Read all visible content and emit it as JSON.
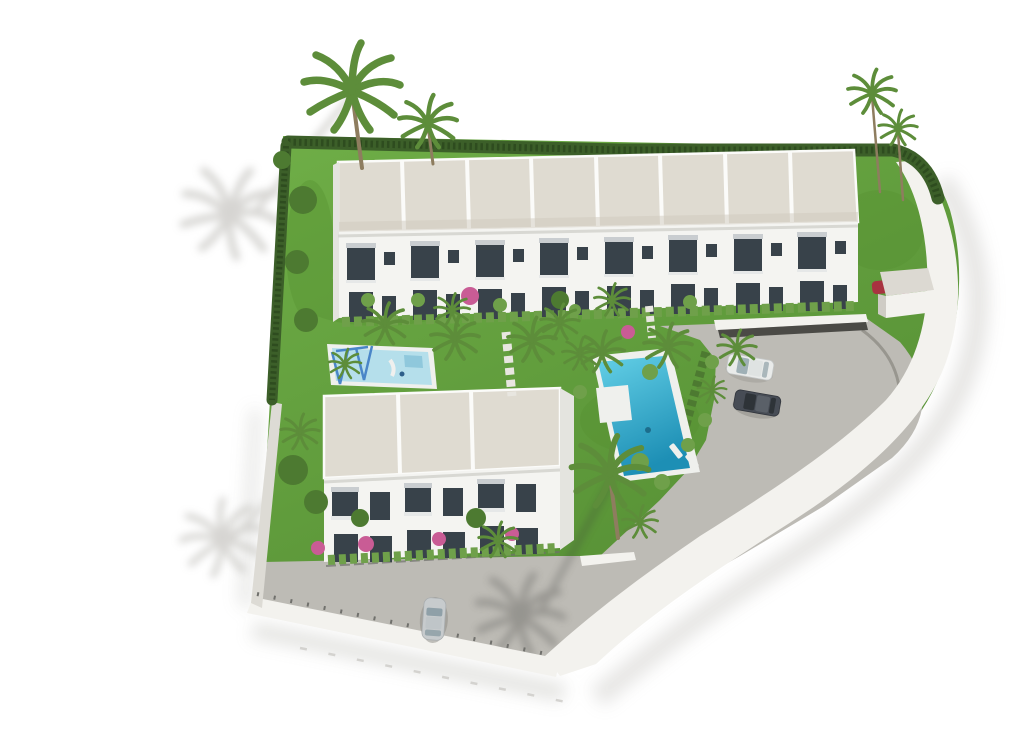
{
  "scene": {
    "type": "architectural-3d-aerial-render",
    "subject": "Aerial 3D rendering of a white Mediterranean townhouse development with landscaped gardens, a communal swimming pool, a children's pool with playground, parking with cars, palm trees and a curved white perimeter wall",
    "top_building_units": 8,
    "bottom_building_units": 3,
    "pools": [
      "main-pool",
      "kids-pool"
    ],
    "cars": [
      "white-suv",
      "dark-sedan",
      "silver-car-top-view",
      "red-car-behind-gatehouse"
    ],
    "vegetation": [
      "palm-trees",
      "perimeter-hedge",
      "bougainvillea",
      "lawn",
      "shrubs"
    ]
  },
  "colors": {
    "background": "#ffffff",
    "grass": "#68a53f",
    "grassDark": "#559030",
    "hedge": "#3c5f29",
    "hedgeTexture": "#2e4c1f",
    "roof": "#dfdbd1",
    "roofShade": "#cfcabe",
    "facade": "#f4f4f1",
    "facadeShade": "#e4e4df",
    "glass": "#38424a",
    "poolLight": "#5fcde6",
    "poolDeep": "#1d92b9",
    "kidsPool": "#b5dfeb",
    "poolDeck": "#eff0ed",
    "pavement": "#bdbbb5",
    "wall": "#f3f2ee",
    "wallShadow": "#dddbd5",
    "shadow": "#cccbc7",
    "palm": "#5d8d3a",
    "treeGreen": "#4d7a31",
    "bushLight": "#6fa04a",
    "trunk": "#8e7d5f",
    "bushPink": "#c95c95",
    "carWhite": "#e9ebea",
    "carDark": "#474c55",
    "carSilver": "#c7cbcd",
    "carRed": "#a83340",
    "swingBlue": "#4a86c8",
    "pergolaDark": "#3e3e3a",
    "fencePost": "#70706c"
  }
}
